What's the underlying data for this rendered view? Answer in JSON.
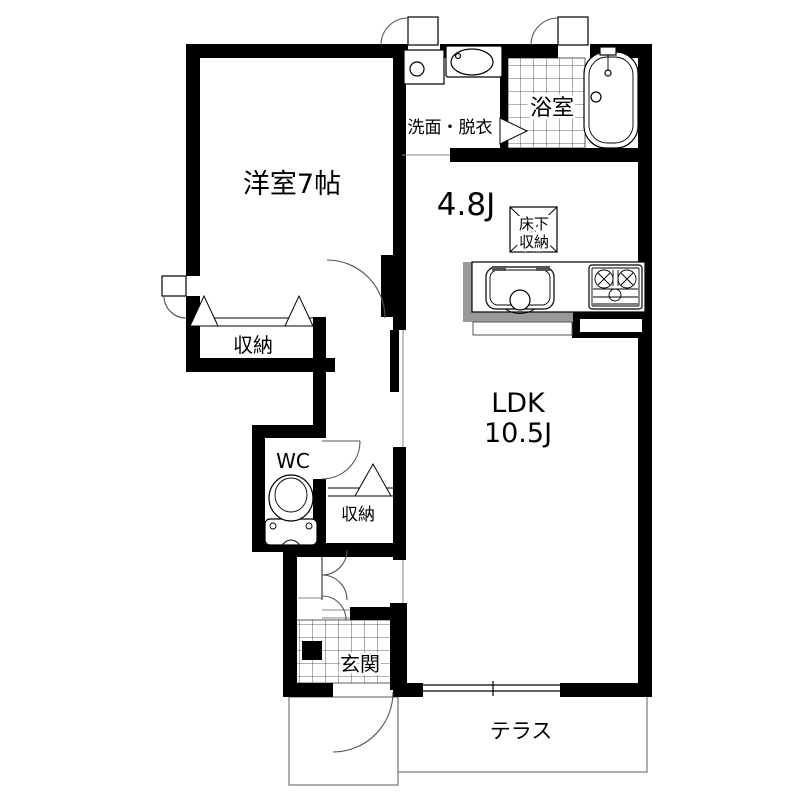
{
  "floor_plan": {
    "rooms": {
      "western_room": "洋室7帖",
      "washroom": "洗面・脱衣",
      "bathroom": "浴室",
      "dining_kitchen": "4.8J",
      "underfloor_storage_line1": "床下",
      "underfloor_storage_line2": "収納",
      "ldk_line1": "LDK",
      "ldk_line2": "10.5J",
      "closet1": "収納",
      "toilet_room": "WC",
      "closet2": "収納",
      "entrance": "玄関",
      "terrace": "テラス"
    }
  }
}
